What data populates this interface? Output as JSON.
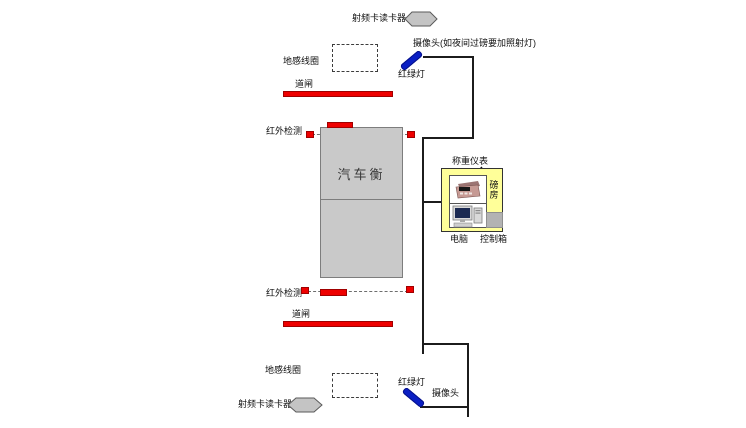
{
  "diagram": {
    "top": {
      "rfid_label": "射频卡读卡器",
      "camera_label": "摄像头(如夜间过磅要加照射灯)",
      "ground_coil_label": "地感线圈",
      "barrier_label": "道闸",
      "infrared_label": "红外检测",
      "traffic_light_label": "红绿灯"
    },
    "scale_label": "汽车衡",
    "weigh_station": {
      "indicator_label": "称重仪表",
      "house_char1": "磅",
      "house_char2": "房",
      "computer_label": "电脑",
      "control_box_label": "控制箱"
    },
    "bottom": {
      "infrared_label": "红外检测",
      "barrier_label": "道闸",
      "ground_coil_label": "地感线圈",
      "rfid_label": "射频卡读卡器",
      "traffic_light_label": "红绿灯",
      "camera_label": "摄像头"
    },
    "colors": {
      "red": "#ee0000",
      "blue": "#0a1fc4",
      "yellow": "#ffff99",
      "scale-gray": "#c9c9c9",
      "hex-gray": "#c4c4c4"
    }
  }
}
